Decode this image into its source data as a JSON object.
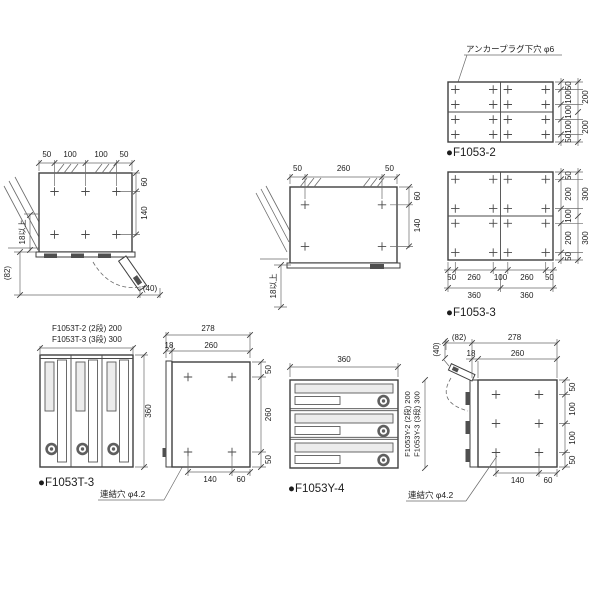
{
  "t_top_view": {
    "top_dims": [
      "50",
      "100",
      "100",
      "50"
    ],
    "right_dims": [
      "60",
      "140"
    ],
    "clearance_note": "18以上",
    "depth_ref": "(82)",
    "door_open_ref": "(40)"
  },
  "y_top_view": {
    "top_dims": [
      "50",
      "260",
      "50"
    ],
    "right_dims": [
      "60",
      "140"
    ],
    "clearance_note": "18以上"
  },
  "f1053_2_plate": {
    "callout": "アンカープラグ下穴 φ6",
    "label": "●F1053-2",
    "right_dims": [
      "50",
      "100",
      "100",
      "100",
      "50"
    ],
    "right_overall_dims": [
      "200",
      "200"
    ]
  },
  "f1053_3_plate": {
    "label": "●F1053-3",
    "right_dims": [
      "50",
      "200",
      "100",
      "200",
      "50"
    ],
    "right_overall_dims": [
      "300",
      "300"
    ],
    "bottom_dims": [
      "50",
      "260",
      "100",
      "260",
      "50"
    ],
    "bottom_overall_dims": [
      "360",
      "360"
    ]
  },
  "t_front_view": {
    "label": "●F1053T-3",
    "width_note": [
      "F1053T-2 (2段) 200",
      "F1053T-3 (3段) 300"
    ],
    "height_dim": "360",
    "callout": "連結穴 φ4.2"
  },
  "t_side_view": {
    "top_dim": "278",
    "top_sub_dims": [
      "18",
      "260"
    ],
    "right_dims": [
      "50",
      "260",
      "50"
    ],
    "bottom_dims": [
      "140",
      "60"
    ]
  },
  "y_front_view": {
    "label": "●F1053Y-4",
    "width_dim": "360",
    "height_note": [
      "F1053Y-2 (2段) 200",
      "F1053Y-3 (3段) 300"
    ]
  },
  "y_side_view": {
    "top_dims": [
      "(82)",
      "278"
    ],
    "top_sub_dims": [
      "18",
      "260"
    ],
    "right_dims": [
      "50",
      "100",
      "100",
      "50"
    ],
    "bottom_dims": [
      "140",
      "60"
    ],
    "door_open_ref": "(40)",
    "callout": "連結穴 φ4.2"
  }
}
